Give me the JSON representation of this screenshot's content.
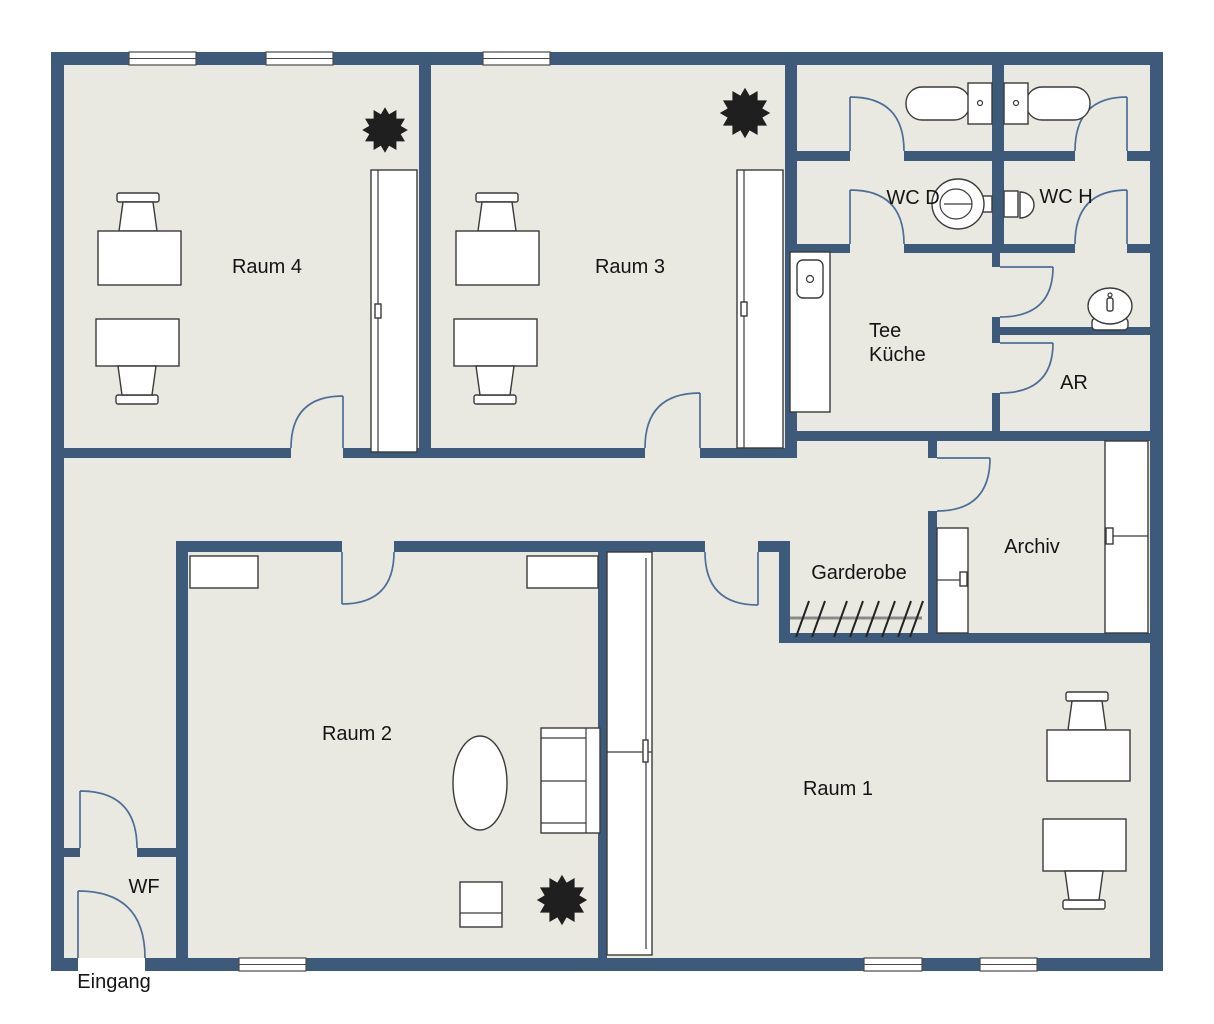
{
  "colors": {
    "wall": "#3e5a7b",
    "floor": "#e9e9e2",
    "door": "#4e6e96",
    "furniture": "#3a3a3a",
    "window_frame": "#4a4a4a",
    "plant": "#1f1f1f",
    "text": "#141414",
    "background": "#ffffff"
  },
  "labels": {
    "raum4": "Raum 4",
    "raum3": "Raum 3",
    "wc_d": "WC D",
    "wc_h": "WC H",
    "tee_line1": "Tee",
    "tee_line2": "Küche",
    "ar": "AR",
    "archiv": "Archiv",
    "garderobe": "Garderobe",
    "raum2": "Raum 2",
    "raum1": "Raum 1",
    "wf": "WF",
    "eingang": "Eingang"
  }
}
